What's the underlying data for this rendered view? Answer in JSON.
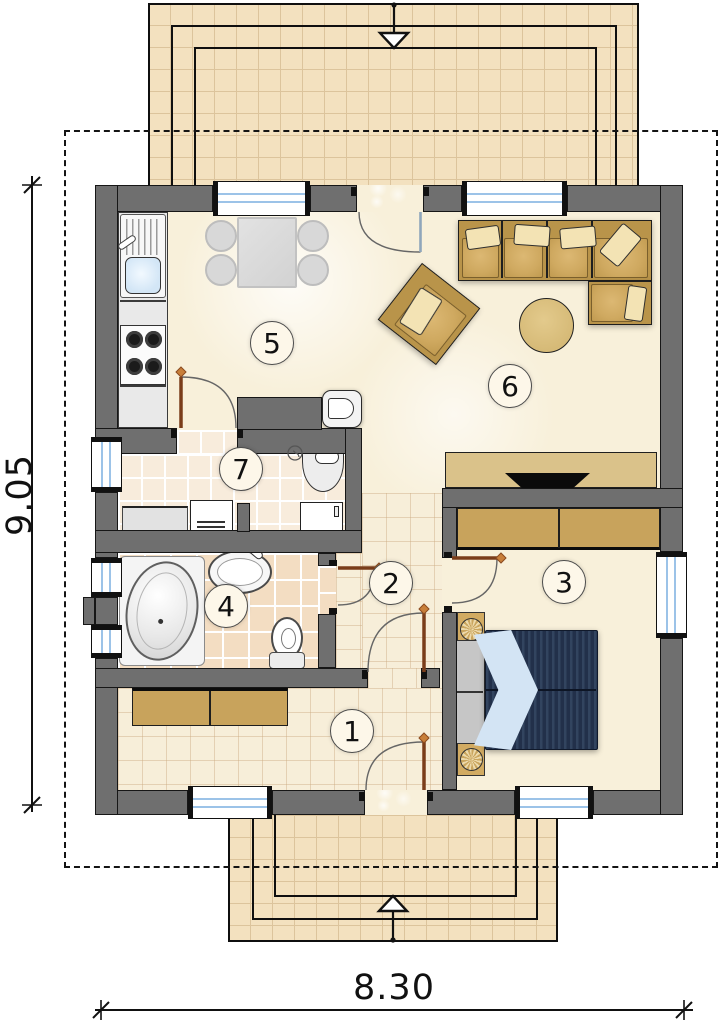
{
  "dimensions": {
    "height_label": "9.05",
    "width_label": "8.30"
  },
  "room_labels": {
    "entry_hall": "1",
    "corridor": "2",
    "bedroom": "3",
    "bathroom": "4",
    "kitchen": "5",
    "living_room": "6",
    "utility_wc": "7"
  },
  "colors": {
    "wall": "#6f6f6f",
    "wall_edge": "#161616",
    "terrace_tile": "#f3e1bf",
    "terrace_grid": "#dcc49c",
    "floor": "#f8f0da",
    "warm_tile": "#f8ecdc",
    "bath_tile": "#f3ddc2",
    "furniture_tan": "#b9944a",
    "seat_tan": "#cfa960",
    "cushion": "#f3e3b4",
    "cabinet_tan": "#dac28a",
    "wardrobe_tan": "#c8a35c",
    "table_round": "#d6ba77",
    "bed_navy": "#2a3a55",
    "bed_pillow": "#d3e4f4",
    "door_brown": "#7a3d1a",
    "hinge_orange": "#c87f3a",
    "window_glass": "#9cc3e8",
    "counter_gray": "#e9e9e9",
    "label_fill": "#fdf7e9"
  }
}
